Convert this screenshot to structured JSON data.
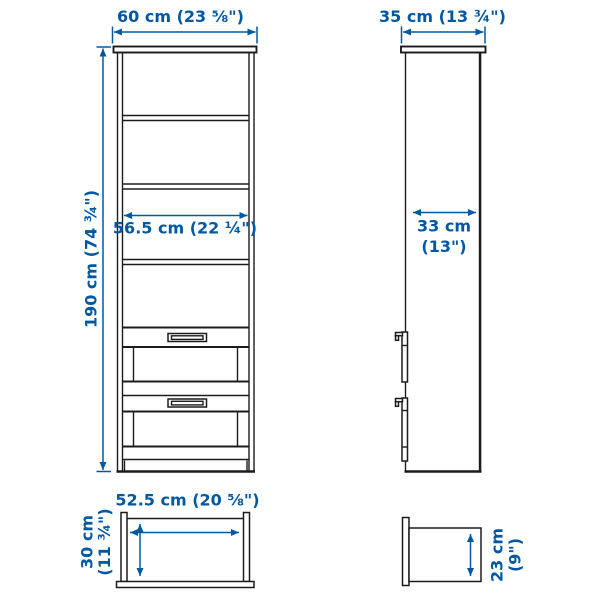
{
  "title": "Bookcase dimensions diagram",
  "colors": {
    "dimension_accent": "#0058a3",
    "furniture_line": "#1c1c1c",
    "background": "#ffffff"
  },
  "front_view": {
    "width_label": "60 cm (23 ⅝\")",
    "height_label": "190 cm (74 ¾\")",
    "inner_width_label": "56.5 cm (22 ¼\")"
  },
  "side_view": {
    "depth_label": "35 cm (13 ¾\")",
    "inner_depth_line1": "33 cm",
    "inner_depth_line2": "(13\")"
  },
  "drawer_top_view": {
    "width_label": "52.5 cm (20 ⅝\")",
    "depth_line1": "30 cm",
    "depth_line2": "(11 ¾\")"
  },
  "drawer_side_view": {
    "height_line1": "23 cm",
    "height_line2": "(9\")"
  }
}
